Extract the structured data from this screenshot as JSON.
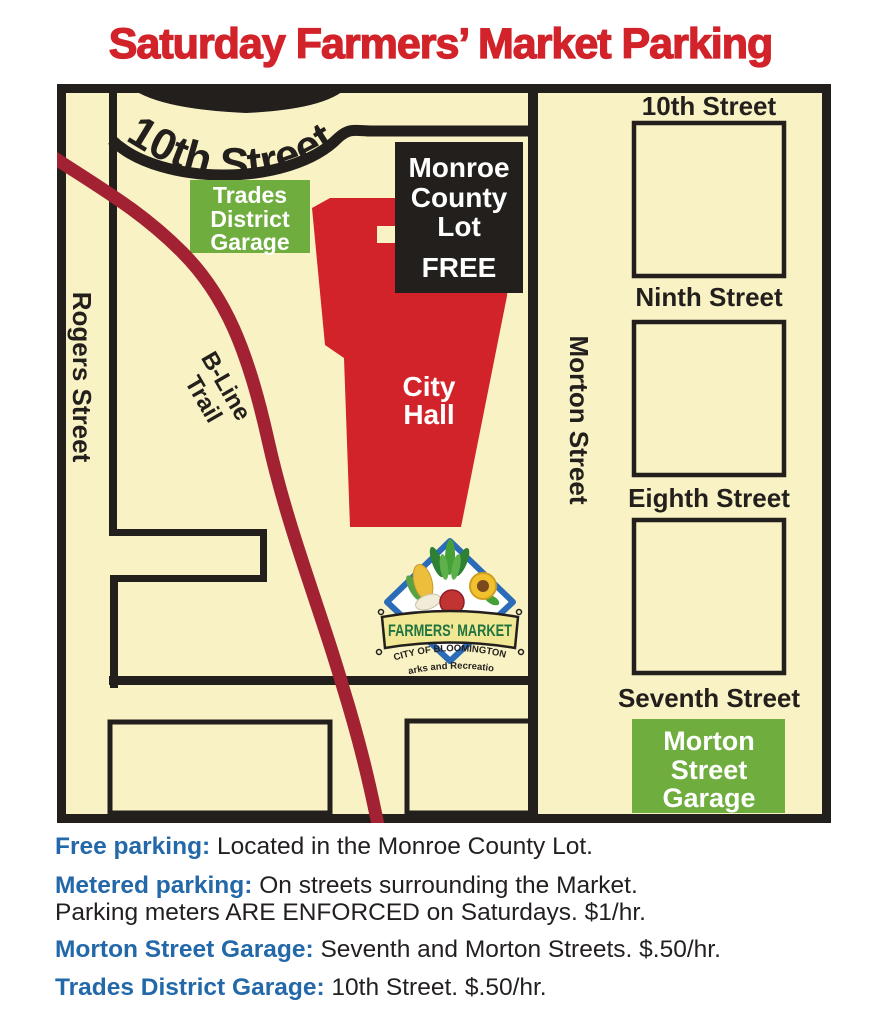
{
  "title": "Saturday Farmers’ Market Parking",
  "colors": {
    "accent_red": "#D2232A",
    "garage_green": "#6FAE3E",
    "trail_maroon": "#A22234",
    "legend_blue": "#2368A8",
    "map_cream": "#F9F2C5",
    "line_black": "#221F1C"
  },
  "map": {
    "curved_street_label": "10th Street",
    "rogers_street_label": "Rogers Street",
    "morton_street_label": "Morton Street",
    "bline_trail": {
      "line1": "B-Line",
      "line2": "Trail"
    },
    "right_street_labels": [
      "10th Street",
      "Ninth Street",
      "Eighth Street",
      "Seventh Street"
    ],
    "monroe_county_lot": {
      "line1": "Monroe",
      "line2": "County",
      "line3": "Lot",
      "line4": "FREE"
    },
    "city_hall": {
      "line1": "City",
      "line2": "Hall"
    },
    "trades_district_garage": {
      "line1": "Trades",
      "line2": "District",
      "line3": "Garage"
    },
    "morton_street_garage": {
      "line1": "Morton",
      "line2": "Street",
      "line3": "Garage"
    },
    "logo": {
      "banner": "FARMERS' MARKET",
      "org": "CITY OF BLOOMINGTON",
      "dept": "Parks and Recreation"
    }
  },
  "legend": {
    "items": [
      {
        "label": "Free parking:",
        "text": " Located in the Monroe County Lot."
      },
      {
        "label": "Metered parking:",
        "text": " On streets surrounding the Market.",
        "line2": "Parking meters ARE ENFORCED on Saturdays. $1/hr."
      },
      {
        "label": "Morton Street Garage:",
        "text": " Seventh and Morton Streets. $.50/hr."
      },
      {
        "label": "Trades District Garage:",
        "text": " 10th Street. $.50/hr."
      }
    ]
  }
}
